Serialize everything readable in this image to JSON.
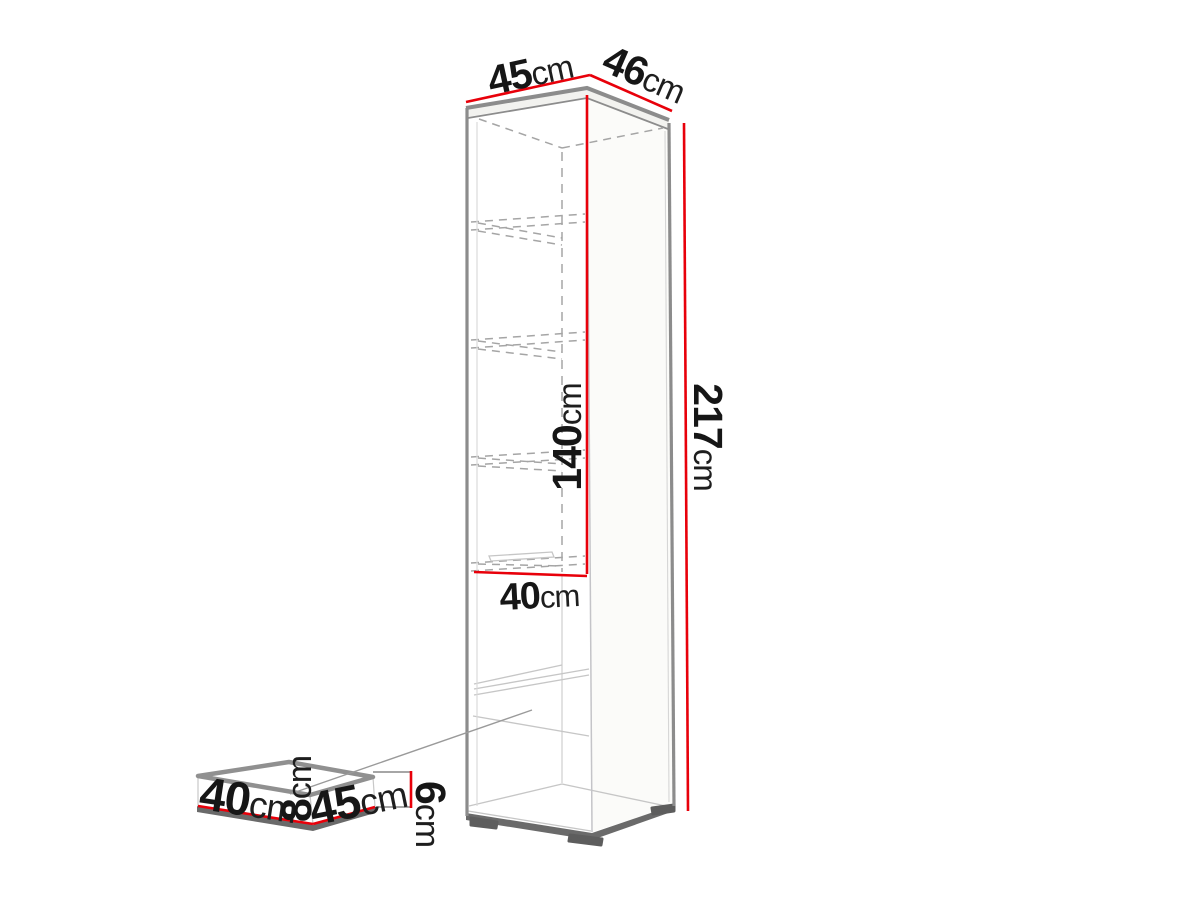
{
  "diagram": {
    "type": "furniture-dimension-diagram",
    "subject": "tall cabinet with exploded shelf insert",
    "accent_color": "#e8000a",
    "outline_color": "#8c8c8c",
    "background_color": "#ffffff"
  },
  "dims": {
    "top_width": {
      "num": "45",
      "unit": "cm"
    },
    "top_depth": {
      "num": "46",
      "unit": "cm"
    },
    "total_height": {
      "num": "217",
      "unit": "cm"
    },
    "interior_height": {
      "num": "140",
      "unit": "cm"
    },
    "interior_width": {
      "num": "40",
      "unit": "cm"
    },
    "insert_width": {
      "num": "40",
      "unit": "cm"
    },
    "insert_height": {
      "num": "8",
      "unit": "cm"
    },
    "insert_depth": {
      "num": "45",
      "unit": "cm"
    },
    "insert_thickness": {
      "num": "6",
      "unit": "cm"
    }
  }
}
